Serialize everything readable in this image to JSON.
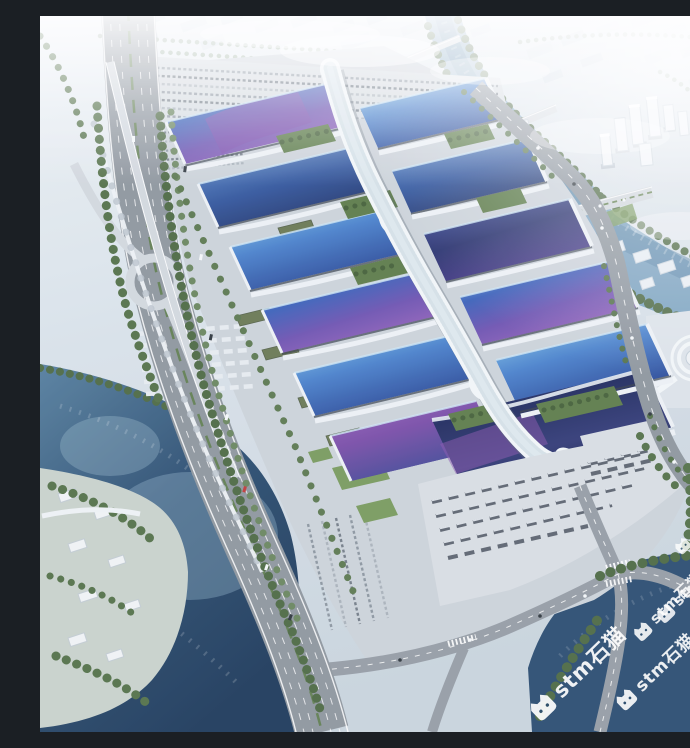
{
  "watermark": {
    "text": "stm石猫",
    "icon": "cat-icon",
    "color": "#ffffff",
    "rotation_deg": -44,
    "instance_count": 5
  },
  "palette": {
    "haze": "#e9eff4",
    "city_block": "#d4dee6",
    "concrete": "#ccd3da",
    "plaza": "#d9dee3",
    "road_gray": "#8f979f",
    "ramp_gray": "#d2d8de",
    "water_light": "#86abc6",
    "water_dark": "#2d4f72",
    "tree_green": "#55724a",
    "lawn_green": "#7a9b5f",
    "roof_cyan": "#8ed1ec",
    "roof_blue": "#3d63ba",
    "roof_navy": "#232f6e",
    "roof_purple": "#7e55b0",
    "spine_white": "#f2f6f8"
  }
}
